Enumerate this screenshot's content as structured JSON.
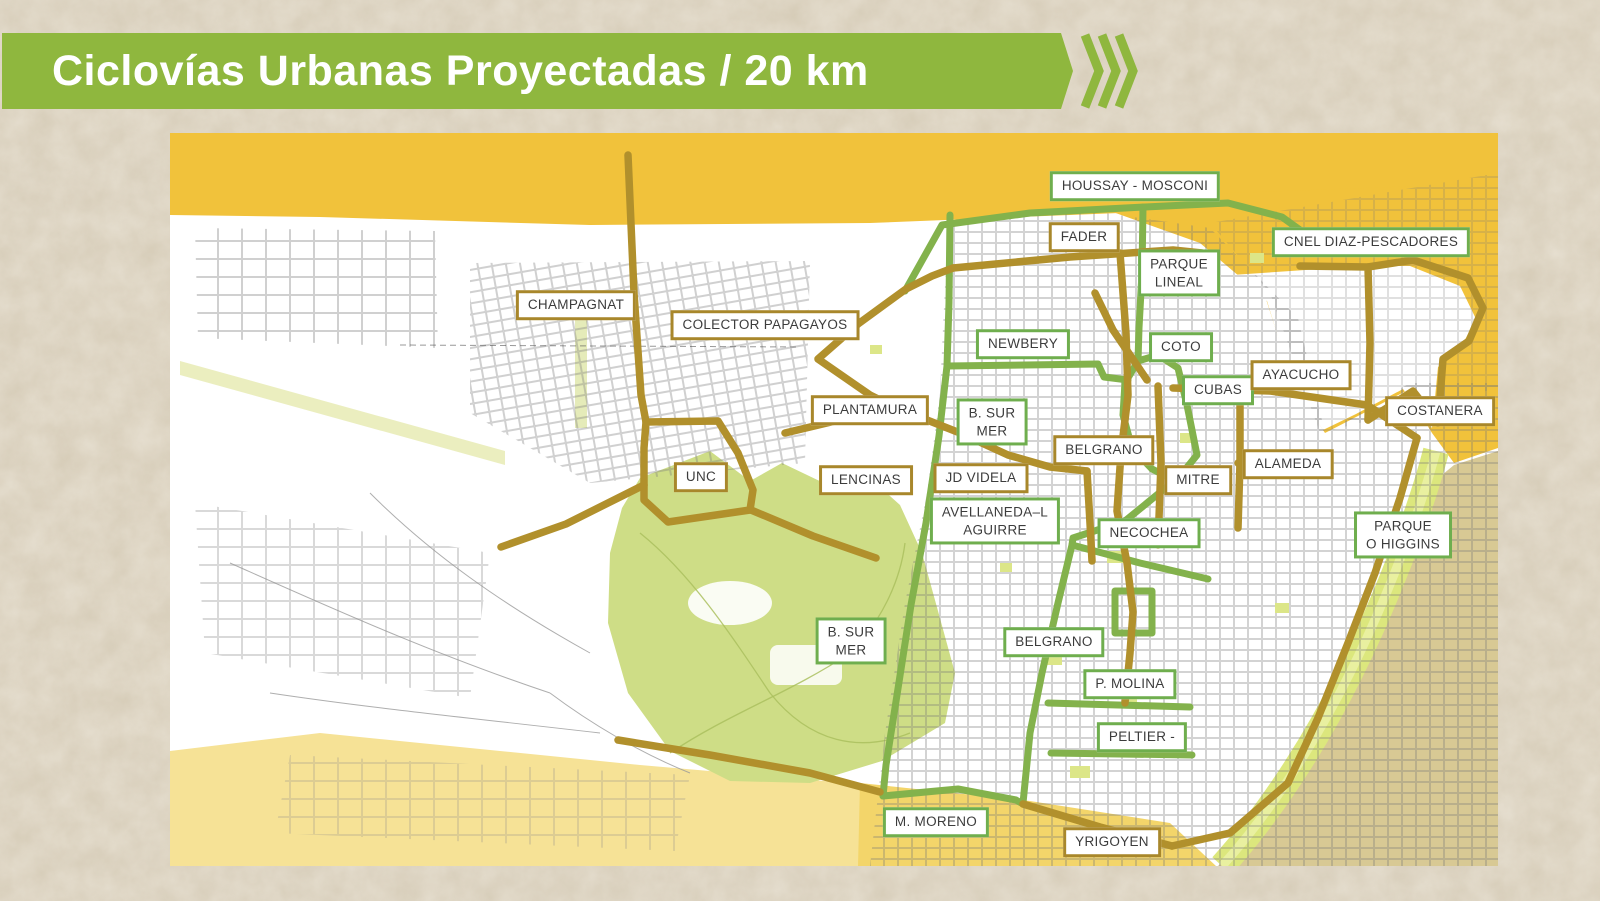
{
  "header": {
    "title": "Ciclovías Urbanas Proyectadas / 20 km"
  },
  "palette": {
    "banner_green": "#8fb73e",
    "route_green": "#83b24c",
    "route_gold": "#b1902c",
    "label_border_green": "#6fae4e",
    "label_border_gold": "#a8872b",
    "map_orange": "#f1c23b",
    "map_yellow": "#f3d56a",
    "map_yellow_light": "#f6e296",
    "map_tan": "#d8c994",
    "park_green": "#cedd86",
    "coast_green": "#dce77d",
    "page_bg": "#e8e1d3",
    "label_text": "#3c3c3c"
  },
  "map": {
    "labels": [
      {
        "id": "houssay-mosconi",
        "lines": [
          "HOUSSAY - MOSCONI"
        ],
        "border": "green",
        "x": 965,
        "y": 53
      },
      {
        "id": "fader",
        "lines": [
          "FADER"
        ],
        "border": "gold",
        "x": 914,
        "y": 104
      },
      {
        "id": "parque-lineal",
        "lines": [
          "PARQUE",
          "LINEAL"
        ],
        "border": "green",
        "x": 1009,
        "y": 140
      },
      {
        "id": "cnel-diaz-pescadores",
        "lines": [
          "CNEL DIAZ-PESCADORES"
        ],
        "border": "green",
        "x": 1201,
        "y": 109
      },
      {
        "id": "champagnat",
        "lines": [
          "CHAMPAGNAT"
        ],
        "border": "gold",
        "x": 406,
        "y": 172
      },
      {
        "id": "colector-papagayos",
        "lines": [
          "COLECTOR PAPAGAYOS"
        ],
        "border": "gold",
        "x": 595,
        "y": 192
      },
      {
        "id": "newbery",
        "lines": [
          "NEWBERY"
        ],
        "border": "green",
        "x": 853,
        "y": 211
      },
      {
        "id": "coto",
        "lines": [
          "COTO"
        ],
        "border": "green",
        "x": 1011,
        "y": 214
      },
      {
        "id": "cubas",
        "lines": [
          "CUBAS"
        ],
        "border": "green",
        "x": 1048,
        "y": 257
      },
      {
        "id": "ayacucho",
        "lines": [
          "AYACUCHO"
        ],
        "border": "gold",
        "x": 1131,
        "y": 242
      },
      {
        "id": "costanera",
        "lines": [
          "COSTANERA"
        ],
        "border": "gold",
        "x": 1270,
        "y": 278
      },
      {
        "id": "plantamura",
        "lines": [
          "PLANTAMURA"
        ],
        "border": "gold",
        "x": 700,
        "y": 277
      },
      {
        "id": "b-sur-mer-norte",
        "lines": [
          "B. SUR",
          "MER"
        ],
        "border": "green",
        "x": 822,
        "y": 289
      },
      {
        "id": "belgrano-norte",
        "lines": [
          "BELGRANO"
        ],
        "border": "gold",
        "x": 934,
        "y": 317
      },
      {
        "id": "alameda",
        "lines": [
          "ALAMEDA"
        ],
        "border": "gold",
        "x": 1118,
        "y": 331
      },
      {
        "id": "mitre",
        "lines": [
          "MITRE"
        ],
        "border": "gold",
        "x": 1028,
        "y": 347
      },
      {
        "id": "unc",
        "lines": [
          "UNC"
        ],
        "border": "gold",
        "x": 531,
        "y": 344
      },
      {
        "id": "lencinas",
        "lines": [
          "LENCINAS"
        ],
        "border": "gold",
        "x": 696,
        "y": 347
      },
      {
        "id": "jd-videla",
        "lines": [
          "JD VIDELA"
        ],
        "border": "gold",
        "x": 811,
        "y": 345
      },
      {
        "id": "avellaneda-l-aguirre",
        "lines": [
          "AVELLANEDA–L",
          "AGUIRRE"
        ],
        "border": "green",
        "x": 825,
        "y": 388
      },
      {
        "id": "necochea",
        "lines": [
          "NECOCHEA"
        ],
        "border": "green",
        "x": 979,
        "y": 400
      },
      {
        "id": "parque-o-higgins",
        "lines": [
          "PARQUE",
          "O HIGGINS"
        ],
        "border": "green",
        "x": 1233,
        "y": 402
      },
      {
        "id": "b-sur-mer-sur",
        "lines": [
          "B. SUR",
          "MER"
        ],
        "border": "green",
        "x": 681,
        "y": 508
      },
      {
        "id": "belgrano-sur",
        "lines": [
          "BELGRANO"
        ],
        "border": "green",
        "x": 884,
        "y": 509
      },
      {
        "id": "p-molina",
        "lines": [
          "P. MOLINA"
        ],
        "border": "green",
        "x": 960,
        "y": 551
      },
      {
        "id": "peltier",
        "lines": [
          "PELTIER -"
        ],
        "border": "green",
        "x": 972,
        "y": 604
      },
      {
        "id": "m-moreno",
        "lines": [
          "M. MORENO"
        ],
        "border": "green",
        "x": 766,
        "y": 689
      },
      {
        "id": "yrigoyen",
        "lines": [
          "YRIGOYEN"
        ],
        "border": "gold",
        "x": 942,
        "y": 709
      }
    ],
    "routes": [
      {
        "name": "houssay-mosconi",
        "color": "green",
        "points": [
          [
            735,
            158
          ],
          [
            772,
            92
          ],
          [
            860,
            80
          ],
          [
            975,
            74
          ],
          [
            1058,
            70
          ],
          [
            1112,
            84
          ],
          [
            1130,
            97
          ]
        ]
      },
      {
        "name": "parque-lineal",
        "color": "green",
        "points": [
          [
            973,
            74
          ],
          [
            972,
            140
          ],
          [
            969,
            195
          ],
          [
            968,
            228
          ]
        ]
      },
      {
        "name": "parque-lineal-plaza",
        "color": "green",
        "closed": true,
        "fill": "#e7edb0",
        "points": [
          [
            968,
            228
          ],
          [
            955,
            250
          ],
          [
            953,
            282
          ],
          [
            962,
            315
          ],
          [
            982,
            336
          ],
          [
            1006,
            348
          ],
          [
            1027,
            322
          ],
          [
            1017,
            272
          ],
          [
            1008,
            235
          ],
          [
            988,
            222
          ]
        ]
      },
      {
        "name": "b-sur-mer",
        "color": "green",
        "points": [
          [
            780,
            82
          ],
          [
            779,
            170
          ],
          [
            777,
            233
          ],
          [
            769,
            303
          ],
          [
            756,
            390
          ],
          [
            741,
            472
          ],
          [
            727,
            562
          ],
          [
            716,
            632
          ],
          [
            713,
            663
          ]
        ]
      },
      {
        "name": "moreno-enlace",
        "color": "green",
        "points": [
          [
            713,
            663
          ],
          [
            788,
            656
          ],
          [
            846,
            667
          ],
          [
            853,
            671
          ]
        ]
      },
      {
        "name": "newbery",
        "color": "green",
        "points": [
          [
            777,
            233
          ],
          [
            928,
            231
          ],
          [
            934,
            244
          ],
          [
            958,
            247
          ]
        ]
      },
      {
        "name": "avellaneda-aguirre",
        "color": "green",
        "points": [
          [
            1004,
            348
          ],
          [
            955,
            388
          ],
          [
            903,
            405
          ],
          [
            902,
            412
          ]
        ]
      },
      {
        "name": "necochea",
        "color": "green",
        "points": [
          [
            902,
            412
          ],
          [
            970,
            430
          ],
          [
            1038,
            446
          ]
        ]
      },
      {
        "name": "belgrano-sur",
        "color": "green",
        "points": [
          [
            902,
            412
          ],
          [
            888,
            470
          ],
          [
            872,
            540
          ],
          [
            860,
            600
          ],
          [
            853,
            670
          ]
        ]
      },
      {
        "name": "p-molina",
        "color": "green",
        "points": [
          [
            878,
            570
          ],
          [
            1020,
            574
          ]
        ]
      },
      {
        "name": "peltier",
        "color": "green",
        "points": [
          [
            881,
            620
          ],
          [
            1022,
            622
          ]
        ]
      },
      {
        "name": "plaza-ring",
        "color": "green",
        "closed": true,
        "fill": "#e9efc4",
        "points": [
          [
            945,
            458
          ],
          [
            982,
            458
          ],
          [
            982,
            500
          ],
          [
            945,
            500
          ]
        ]
      },
      {
        "name": "champagnat",
        "color": "gold",
        "points": [
          [
            458,
            22
          ],
          [
            464,
            160
          ],
          [
            471,
            262
          ],
          [
            476,
            289
          ]
        ]
      },
      {
        "name": "unc-anillo",
        "color": "gold",
        "closed": true,
        "points": [
          [
            476,
            289
          ],
          [
            548,
            288
          ],
          [
            568,
            320
          ],
          [
            583,
            357
          ],
          [
            580,
            377
          ],
          [
            498,
            389
          ],
          [
            474,
            367
          ],
          [
            474,
            315
          ]
        ]
      },
      {
        "name": "unc-oeste",
        "color": "gold",
        "points": [
          [
            474,
            352
          ],
          [
            396,
            391
          ],
          [
            331,
            414
          ]
        ]
      },
      {
        "name": "unc-este",
        "color": "gold",
        "points": [
          [
            581,
            377
          ],
          [
            643,
            403
          ],
          [
            706,
            425
          ]
        ]
      },
      {
        "name": "colector-papagayos",
        "color": "gold",
        "points": [
          [
            783,
            135
          ],
          [
            762,
            143
          ],
          [
            736,
            156
          ],
          [
            688,
            191
          ],
          [
            648,
            226
          ],
          [
            700,
            262
          ],
          [
            724,
            274
          ]
        ]
      },
      {
        "name": "plantamura-videla",
        "color": "gold",
        "points": [
          [
            615,
            300
          ],
          [
            724,
            274
          ],
          [
            790,
            300
          ],
          [
            838,
            322
          ],
          [
            880,
            334
          ],
          [
            917,
            338
          ]
        ]
      },
      {
        "name": "fader",
        "color": "gold",
        "points": [
          [
            783,
            135
          ],
          [
            900,
            124
          ],
          [
            1003,
            117
          ],
          [
            1032,
            120
          ]
        ]
      },
      {
        "name": "coto-diagonal",
        "color": "gold",
        "points": [
          [
            925,
            160
          ],
          [
            943,
            197
          ],
          [
            977,
            247
          ]
        ]
      },
      {
        "name": "belgrano-norte",
        "color": "gold",
        "points": [
          [
            950,
            120
          ],
          [
            956,
            200
          ],
          [
            958,
            262
          ],
          [
            951,
            320
          ],
          [
            947,
            378
          ],
          [
            957,
            430
          ],
          [
            963,
            479
          ],
          [
            960,
            520
          ],
          [
            955,
            570
          ]
        ]
      },
      {
        "name": "mitre-oeste",
        "color": "gold",
        "points": [
          [
            917,
            338
          ],
          [
            920,
            390
          ],
          [
            922,
            428
          ]
        ]
      },
      {
        "name": "mitre",
        "color": "gold",
        "points": [
          [
            988,
            253
          ],
          [
            991,
            330
          ],
          [
            988,
            412
          ]
        ]
      },
      {
        "name": "alameda-vertical",
        "color": "gold",
        "points": [
          [
            1070,
            255
          ],
          [
            1070,
            330
          ],
          [
            1068,
            395
          ]
        ]
      },
      {
        "name": "alameda",
        "color": "gold",
        "points": [
          [
            1068,
            330
          ],
          [
            1160,
            340
          ]
        ]
      },
      {
        "name": "ayacucho",
        "color": "gold",
        "points": [
          [
            1003,
            255
          ],
          [
            1100,
            258
          ],
          [
            1197,
            272
          ],
          [
            1247,
            305
          ]
        ]
      },
      {
        "name": "costanera",
        "color": "gold",
        "points": [
          [
            1247,
            305
          ],
          [
            1230,
            365
          ],
          [
            1205,
            440
          ],
          [
            1178,
            510
          ],
          [
            1148,
            585
          ],
          [
            1118,
            650
          ],
          [
            1060,
            700
          ],
          [
            1002,
            713
          ]
        ]
      },
      {
        "name": "yrigoyen",
        "color": "gold",
        "points": [
          [
            853,
            671
          ],
          [
            930,
            694
          ],
          [
            1002,
            713
          ]
        ]
      },
      {
        "name": "m-moreno",
        "color": "gold",
        "points": [
          [
            448,
            607
          ],
          [
            540,
            622
          ],
          [
            640,
            640
          ],
          [
            710,
            659
          ]
        ]
      },
      {
        "name": "cnel-diaz-oeste",
        "color": "gold",
        "points": [
          [
            1130,
            133
          ],
          [
            1198,
            134
          ],
          [
            1200,
            210
          ],
          [
            1198,
            287
          ]
        ]
      },
      {
        "name": "cnel-diaz-pescadores",
        "color": "gold",
        "points": [
          [
            1198,
            134
          ],
          [
            1243,
            127
          ],
          [
            1298,
            145
          ],
          [
            1313,
            175
          ],
          [
            1299,
            208
          ],
          [
            1273,
            226
          ],
          [
            1268,
            290
          ],
          [
            1243,
            258
          ],
          [
            1198,
            287
          ]
        ]
      }
    ]
  }
}
